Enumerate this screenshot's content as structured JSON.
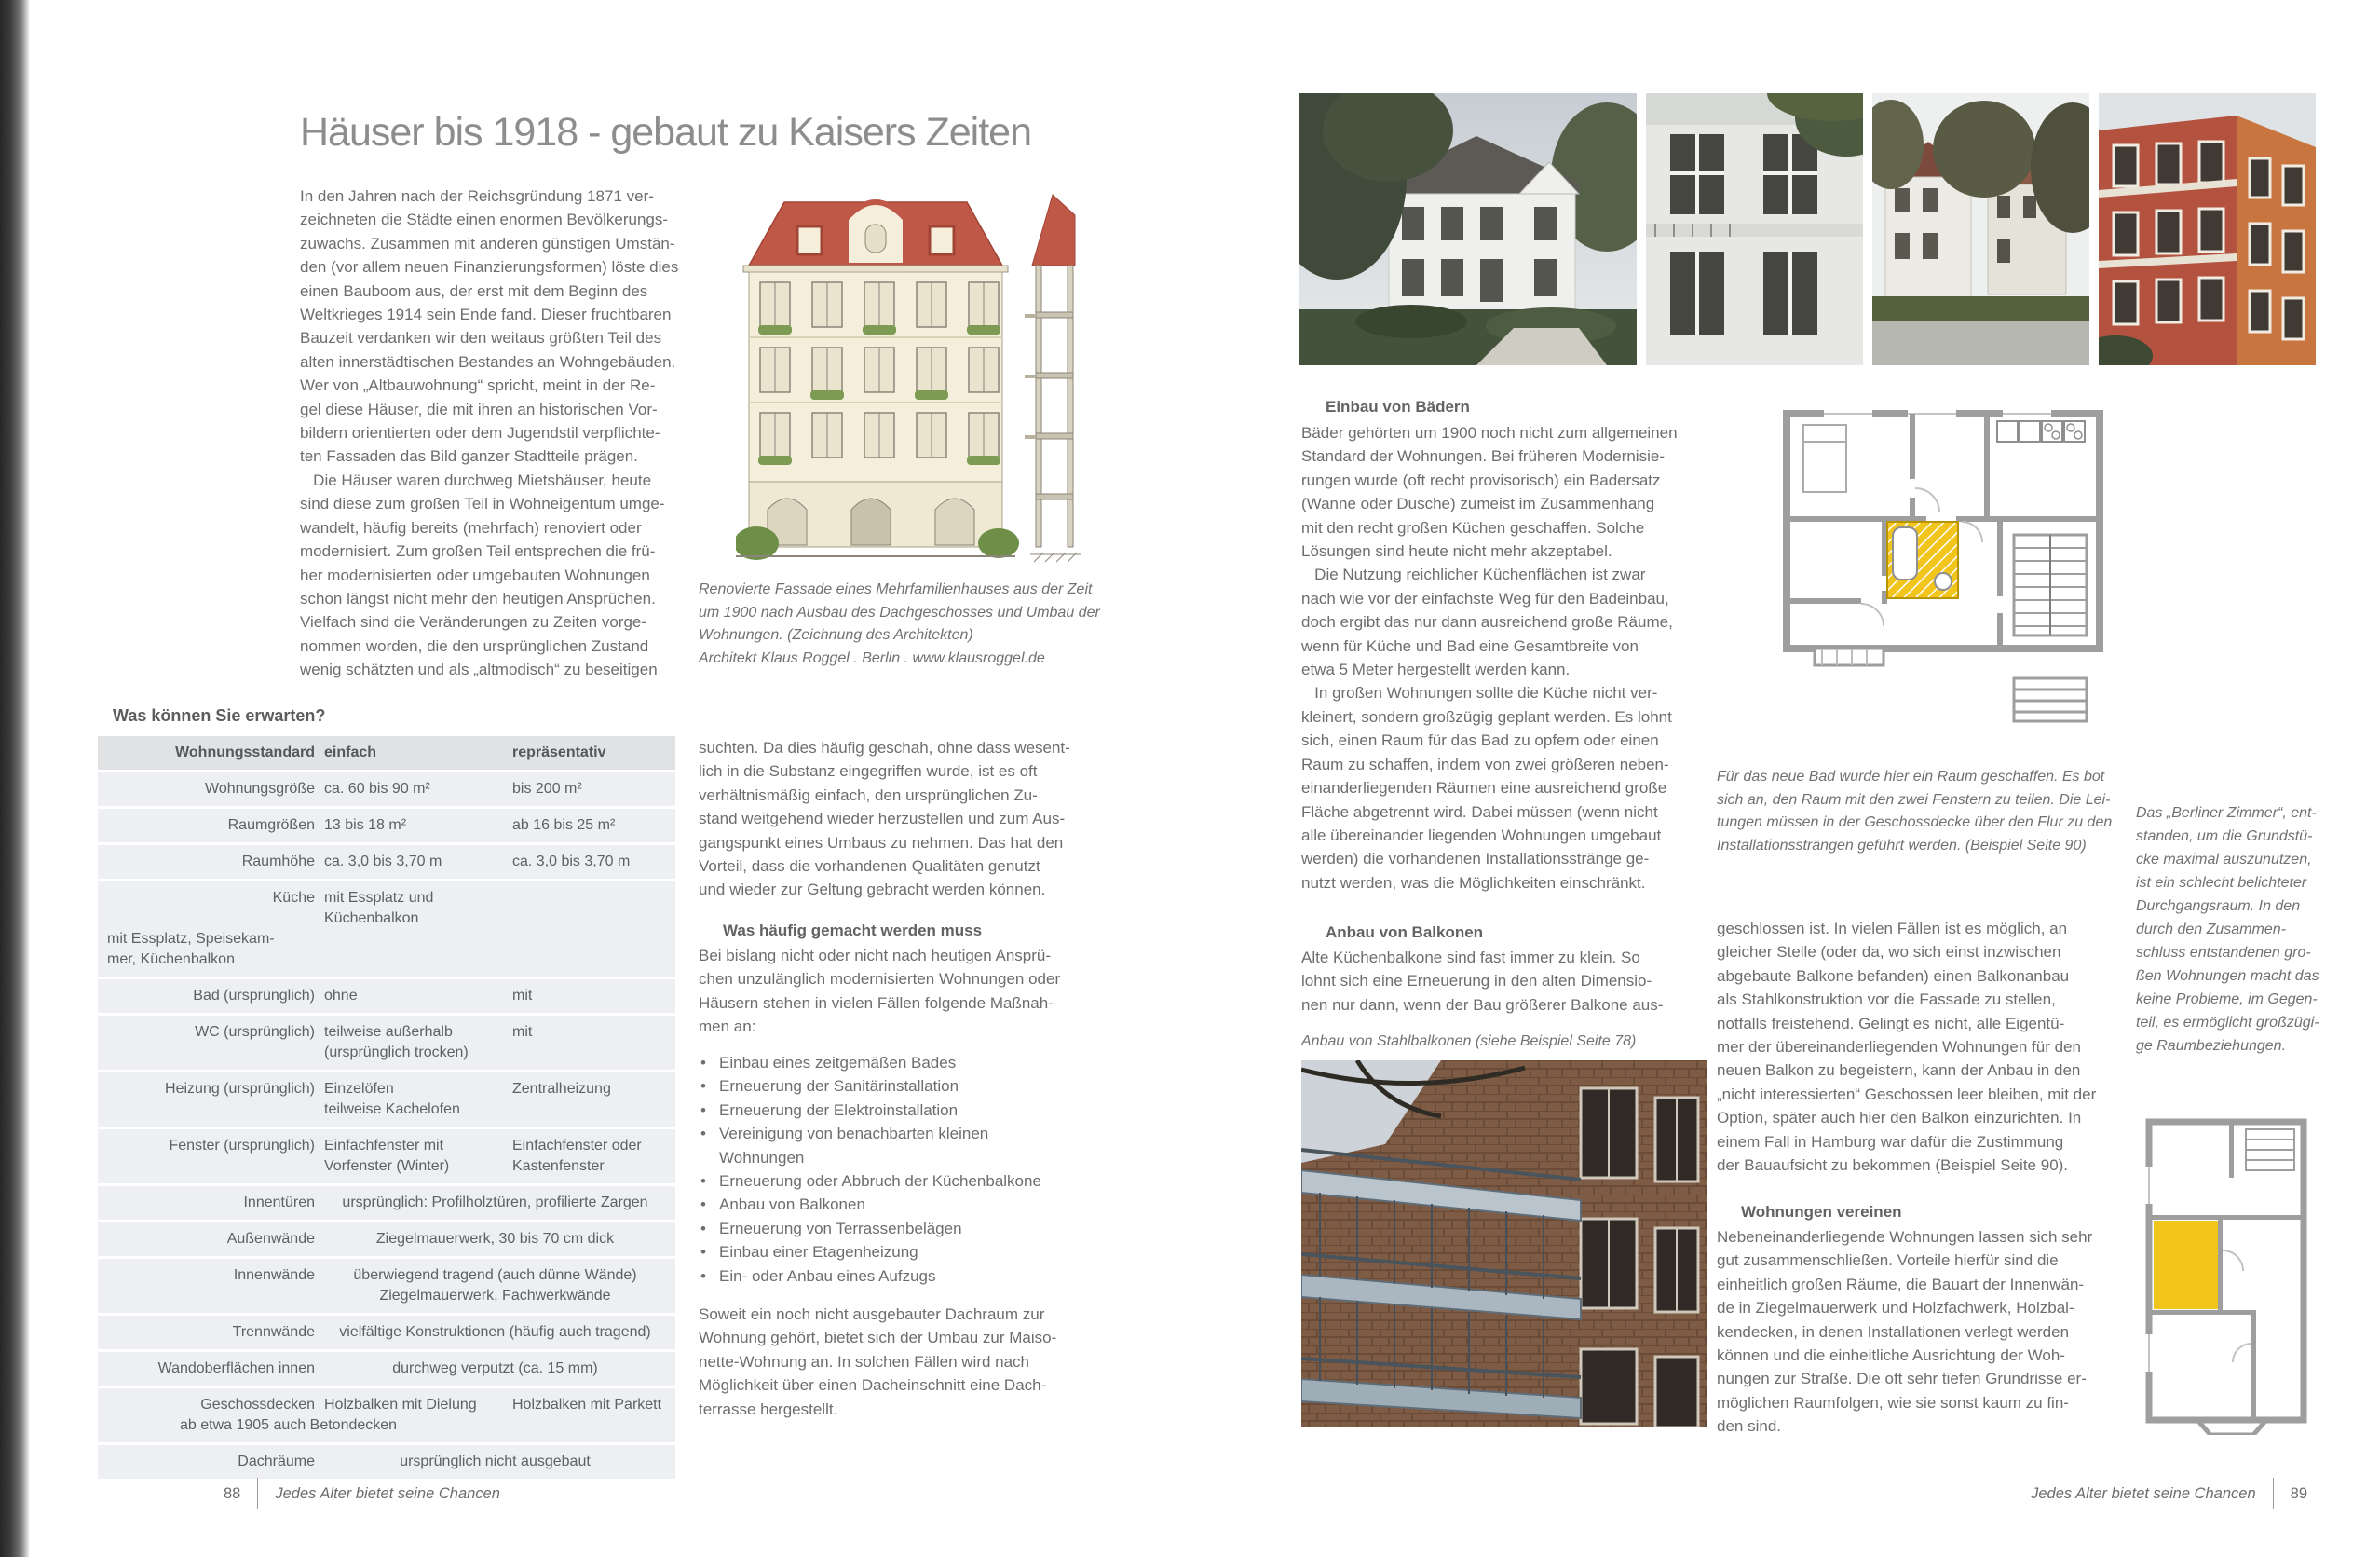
{
  "colors": {
    "roof_red": "#c05848",
    "accent_yellow": "#f2c51d",
    "plan_wall_gray": "#9e9e9e",
    "table_header_bg": "#e0e2e3",
    "table_row_bg": "#edeff2",
    "body_text": "#6d6d6d",
    "title_gray": "#8d8d8d"
  },
  "page_left": {
    "title": "Häuser bis 1918 - gebaut zu Kaisers Zeiten",
    "intro": "In den Jahren nach der Reichsgründung 1871 ver-\nzeichneten die Städte einen enormen Bevölkerungs-\nzuwachs. Zusammen mit anderen günstigen Umstän-\nden (vor allem neuen Finanzierungsformen) löste dies\neinen Bauboom aus, der erst mit dem Beginn des\nWeltkrieges 1914 sein Ende fand. Dieser fruchtbaren\nBauzeit verdanken wir den weitaus größten Teil des\nalten innerstädtischen Bestandes an Wohngebäuden.\nWer von „Altbauwohnung“ spricht, meint in der Re-\ngel diese Häuser, die mit ihren an historischen Vor-\nbildern orientierten oder dem Jugendstil verpflichte-\nten Fassaden das Bild ganzer Stadtteile prägen.\n   Die Häuser waren durchweg Mietshäuser, heute\nsind diese zum großen Teil in Wohneigentum umge-\nwandelt, häufig bereits (mehrfach) renoviert oder\nmodernisiert. Zum großen Teil entsprechen die frü-\nher modernisierten oder umgebauten Wohnungen\nschon längst nicht mehr den heutigen Ansprüchen.\nVielfach sind die Veränderungen zu Zeiten vorge-\nnommen worden, die den ursprünglichen Zustand\nwenig schätzten und als „altmodisch“ zu beseitigen",
    "figure_caption": "Renovierte Fassade eines Mehrfamilienhauses aus der Zeit\num 1900 nach Ausbau des Dachgeschosses und Umbau der\nWohnungen. (Zeichnung des Architekten)\nArchitekt Klaus Roggel . Berlin . www.klausroggel.de",
    "table": {
      "title": "Was können Sie erwarten?",
      "headers": [
        "Wohnungsstandard",
        "einfach",
        "repräsentativ"
      ],
      "rows": [
        {
          "label": "Wohnungsgröße",
          "einfach": "ca. 60 bis 90 m²",
          "rep": "bis 200 m²"
        },
        {
          "label": "Raumgrößen",
          "einfach": "13 bis 18 m²",
          "rep": "ab 16 bis 25 m²"
        },
        {
          "label": "Raumhöhe",
          "einfach": "ca. 3,0 bis 3,70 m",
          "rep": "ca. 3,0 bis 3,70 m"
        },
        {
          "label": "Küche",
          "einfach": "mit Essplatz und\nKüchenbalkon",
          "rep": "mit Essplatz, Speisekam-\nmer, Küchenbalkon"
        },
        {
          "label": "Bad (ursprünglich)",
          "einfach": "ohne",
          "rep": "mit"
        },
        {
          "label": "WC (ursprünglich)",
          "einfach": "teilweise außerhalb\n(ursprünglich trocken)",
          "rep": "mit"
        },
        {
          "label": "Heizung (ursprünglich)",
          "einfach": "Einzelöfen\nteilweise Kachelofen",
          "rep": "Zentralheizung"
        },
        {
          "label": "Fenster (ursprünglich)",
          "einfach": "Einfachfenster mit\nVorfenster (Winter)",
          "rep": "Einfachfenster oder\nKastenfenster"
        },
        {
          "label": "Innentüren",
          "span": "ursprünglich: Profilholztüren, profilierte Zargen"
        },
        {
          "label": "Außenwände",
          "span": "Ziegelmauerwerk, 30 bis 70 cm dick"
        },
        {
          "label": "Innenwände",
          "span": "überwiegend tragend (auch dünne Wände)\nZiegelmauerwerk, Fachwerkwände"
        },
        {
          "label": "Trennwände",
          "span": "vielfältige Konstruktionen (häufig auch tragend)"
        },
        {
          "label": "Wandoberflächen innen",
          "span": "durchweg verputzt (ca. 15 mm)"
        },
        {
          "label": "Geschossdecken",
          "sub": "ab etwa 1905 auch Betondecken",
          "einfach": "Holzbalken mit Dielung",
          "rep": "Holzbalken mit Parkett"
        },
        {
          "label": "Dachräume",
          "span": "ursprünglich nicht ausgebaut"
        }
      ]
    },
    "col2": {
      "para1": "suchten. Da dies häufig geschah, ohne dass wesent-\nlich in die Substanz eingegriffen wurde, ist es oft\nverhältnismäßig einfach, den ursprünglichen Zu-\nstand weitgehend wieder herzustellen und zum Aus-\ngangspunkt eines Umbaus zu nehmen. Das hat den\nVorteil, dass die vorhandenen Qualitäten genutzt\nund wieder zur Geltung gebracht werden können.",
      "subheading": "Was häufig gemacht werden muss",
      "para2": "Bei bislang nicht oder nicht nach heutigen Ansprü-\nchen unzulänglich modernisierten Wohnungen oder\nHäusern stehen in vielen Fällen folgende Maßnah-\nmen an:",
      "bullets": [
        "Einbau eines zeitgemäßen Bades",
        "Erneuerung der Sanitärinstallation",
        "Erneuerung der Elektroinstallation",
        "Vereinigung von benachbarten kleinen\nWohnungen",
        "Erneuerung oder Abbruch der Küchenbalkone",
        "Anbau von Balkonen",
        "Erneuerung von Terrassenbelägen",
        "Einbau einer Etagenheizung",
        "Ein- oder Anbau eines Aufzugs"
      ],
      "para3": "Soweit ein noch nicht ausgebauter Dachraum zur\nWohnung gehört, bietet sich der Umbau zur Maiso-\nnette-Wohnung an. In solchen Fällen wird nach\nMöglichkeit über einen Dacheinschnitt eine Dach-\nterrasse hergestellt."
    },
    "footer": {
      "page_number": "88",
      "text": "Jedes Alter bietet seine Chancen"
    }
  },
  "page_right": {
    "col1": {
      "heading1": "Einbau von Bädern",
      "para1": "Bäder gehörten um 1900 noch nicht zum allgemeinen\nStandard der Wohnungen. Bei früheren Modernisie-\nrungen wurde (oft recht provisorisch) ein Badersatz\n(Wanne oder Dusche) zumeist im Zusammenhang\nmit den recht großen Küchen geschaffen. Solche\nLösungen sind heute nicht mehr akzeptabel.\n   Die Nutzung reichlicher Küchenflächen ist zwar\nnach wie vor der einfachste Weg für den Badeinbau,\ndoch ergibt das nur dann ausreichend große Räume,\nwenn für Küche und Bad eine Gesamtbreite von\netwa 5 Meter hergestellt werden kann.\n   In großen Wohnungen sollte die Küche nicht ver-\nkleinert, sondern großzügig geplant werden. Es lohnt\nsich, einen Raum für das Bad zu opfern oder einen\nRaum zu schaffen, indem von zwei größeren neben-\neinanderliegenden Räumen eine ausreichend große\nFläche abgetrennt wird. Dabei müssen (wenn nicht\nalle übereinander liegenden Wohnungen umgebaut\nwerden) die vorhandenen Installationsstränge ge-\nnutzt werden, was die Möglichkeiten einschränkt.",
      "heading2": "Anbau von Balkonen",
      "para2": "Alte Küchenbalkone sind fast immer zu klein. So\nlohnt sich eine Erneuerung in den alten Dimensio-\nnen nur dann, wenn der Bau größerer Balkone aus-",
      "photo_caption": "Anbau von Stahlbalkonen (siehe Beispiel Seite 78)"
    },
    "col2": {
      "plan_caption": "Für das neue Bad wurde hier ein Raum geschaffen. Es bot\nsich an, den Raum mit den zwei Fenstern zu teilen. Die Lei-\ntungen müssen in der Geschossdecke über den Flur zu den\nInstallationssträngen geführt werden. (Beispiel Seite 90)",
      "para1": "geschlossen ist. In vielen Fällen ist es möglich, an\ngleicher Stelle (oder da, wo sich einst inzwischen\nabgebaute Balkone befanden) einen Balkonanbau\nals Stahlkonstruktion vor die Fassade zu stellen,\nnotfalls freistehend. Gelingt es nicht, alle Eigentü-\nmer der übereinanderliegenden Wohnungen für den\nneuen Balkon zu begeistern, kann der Anbau in den\n„nicht interessierten“ Geschossen leer bleiben, mit der\nOption, später auch hier den Balkon einzurichten. In\neinem Fall in Hamburg war dafür die Zustimmung\nder Bauaufsicht zu bekommen (Beispiel Seite 90).",
      "heading": "Wohnungen vereinen",
      "para2": "Nebeneinanderliegende Wohnungen lassen sich sehr\ngut zusammenschließen. Vorteile hierfür sind die\neinheitlich großen Räume, die Bauart der Innenwän-\nde in Ziegelmauerwerk und Holzfachwerk, Holzbal-\nkendecken, in denen Installationen verlegt werden\nkönnen und die einheitliche Ausrichtung der Woh-\nnungen zur Straße. Die oft sehr tiefen Grundrisse er-\nmöglichen Raumfolgen, wie sie sonst kaum zu fin-\nden sind."
    },
    "col3": {
      "margin_note": "Das „Berliner Zimmer“, ent-\nstanden, um die Grundstü-\ncke maximal auszunutzen,\nist ein schlecht belichteter\nDurchgangsraum. In den\ndurch den Zusammen-\nschluss entstandenen gro-\nßen Wohnungen macht das\nkeine Probleme, im Gegen-\nteil, es ermöglicht großzügi-\nge Raumbeziehungen."
    },
    "footer": {
      "text": "Jedes Alter bietet seine Chancen",
      "page_number": "89"
    }
  }
}
